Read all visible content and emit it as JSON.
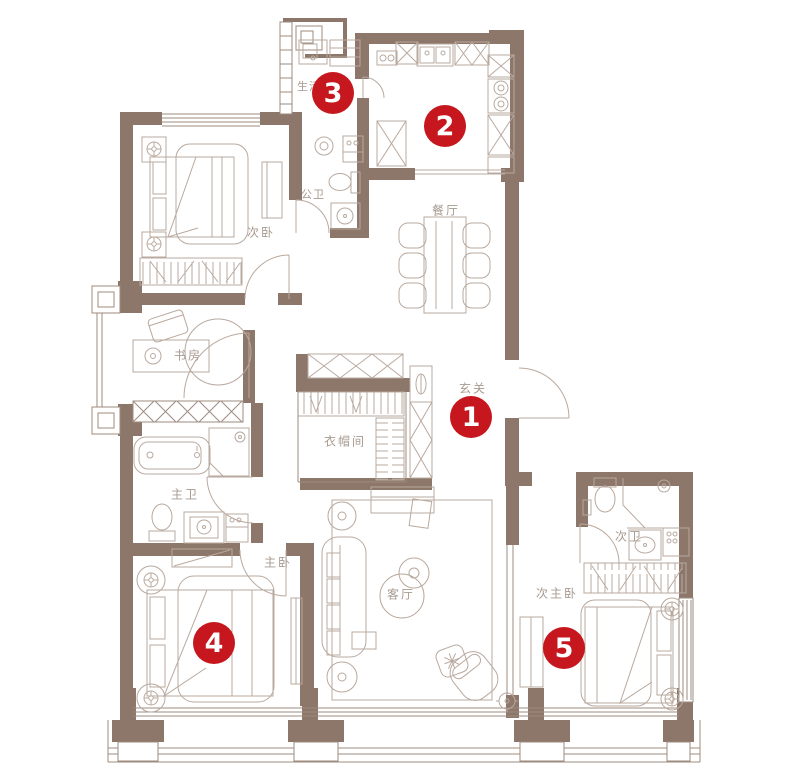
{
  "plan_title": "apartment-floor-plan",
  "palette": {
    "background": "#ffffff",
    "wall": "#8d776a",
    "furniture_line": "#b9a99e",
    "label_text": "#a79a90",
    "marker_background": "#c5171d",
    "marker_text": "#ffffff"
  },
  "rooms": [
    {
      "name": "secondary-bedroom",
      "label": "次卧"
    },
    {
      "name": "guest-bathroom",
      "label": "公卫"
    },
    {
      "name": "dining-room",
      "label": "餐厅"
    },
    {
      "name": "utility-balcony",
      "label": "生活"
    },
    {
      "name": "study",
      "label": "书房"
    },
    {
      "name": "foyer",
      "label": "玄关"
    },
    {
      "name": "cloakroom",
      "label": "衣帽间"
    },
    {
      "name": "master-bathroom",
      "label": "主卫"
    },
    {
      "name": "master-bedroom",
      "label": "主卧"
    },
    {
      "name": "living-room",
      "label": "客厅"
    },
    {
      "name": "second-bathroom",
      "label": "次卫"
    },
    {
      "name": "second-master-bedroom",
      "label": "次主卧"
    }
  ],
  "markers": [
    {
      "number": "1"
    },
    {
      "number": "2"
    },
    {
      "number": "3"
    },
    {
      "number": "4"
    },
    {
      "number": "5"
    }
  ]
}
